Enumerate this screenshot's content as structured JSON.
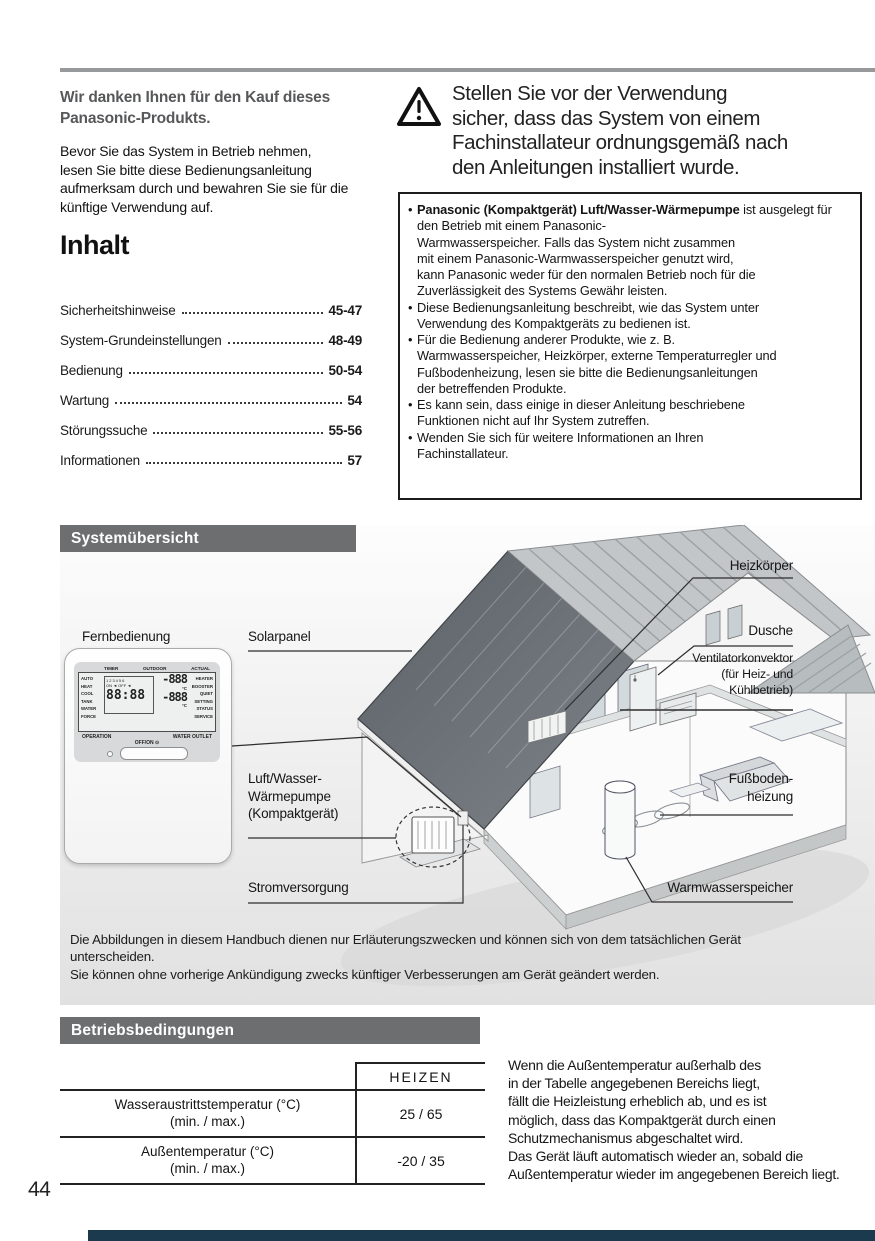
{
  "colors": {
    "section_bar": "#6d6e70",
    "footer_bar": "#1c3a4e",
    "rule": "#97999b"
  },
  "page": {
    "number": "44"
  },
  "intro": {
    "heading": "Wir danken Ihnen für den Kauf dieses Panasonic-Produkts.",
    "body": "Bevor Sie das System in Betrieb nehmen,\nlesen Sie bitte diese Bedienungsanleitung\naufmerksam durch und bewahren Sie sie für die\nkünftige Verwendung auf."
  },
  "toc": {
    "title": "Inhalt",
    "items": [
      {
        "label": "Sicherheitshinweise",
        "pages": "45-47"
      },
      {
        "label": "System-Grundeinstellungen",
        "pages": "48-49"
      },
      {
        "label": "Bedienung",
        "pages": "50-54"
      },
      {
        "label": "Wartung",
        "pages": "54"
      },
      {
        "label": "Störungssuche",
        "pages": "55-56"
      },
      {
        "label": "Informationen",
        "pages": "57"
      }
    ]
  },
  "warning": {
    "text": "Stellen Sie vor der Verwendung\nsicher, dass das System von einem\nFachinstallateur ordnungsgemäß nach\nden Anleitungen installiert wurde."
  },
  "notes_box": {
    "items": [
      {
        "bold": "Panasonic (Kompaktgerät) Luft/Wasser-Wärmepumpe",
        "text": " ist ausgelegt für den Betrieb mit einem Panasonic-\nWarmwasserspeicher. Falls das System nicht zusammen\nmit einem Panasonic-Warmwasserspeicher genutzt wird,\nkann Panasonic weder für den normalen Betrieb noch für die\nZuverlässigkeit des Systems Gewähr leisten."
      },
      {
        "bold": "",
        "text": "Diese Bedienungsanleitung beschreibt, wie das System unter\nVerwendung des Kompaktgeräts zu bedienen ist."
      },
      {
        "bold": "",
        "text": "Für die Bedienung anderer Produkte, wie z. B.\nWarmwasserspeicher, Heizkörper, externe Temperaturregler und\nFußbodenheizung, lesen sie bitte die Bedienungsanleitungen\nder betreffenden Produkte."
      },
      {
        "bold": "",
        "text": "Es kann sein, dass einige in dieser Anleitung beschriebene\nFunktionen nicht auf Ihr System zutreffen."
      },
      {
        "bold": "",
        "text": "Wenden Sie sich für weitere Informationen an Ihren\nFachinstallateur."
      }
    ]
  },
  "system_overview": {
    "title": "Systemübersicht",
    "labels": {
      "fernbedienung": "Fernbedienung",
      "solarpanel": "Solarpanel",
      "heizkoerper": "Heizkörper",
      "dusche": "Dusche",
      "ventilatorkonvektor": "Ventilatorkonvektor\n(für Heiz- und\nKühlbetrieb)",
      "fussbodenheizung": "Fußboden-\nheizung",
      "warmwasserspeicher": "Warmwasserspeicher",
      "luftwasser": "Luft/Wasser-\nWärmepumpe\n(Kompaktgerät)",
      "stromversorgung": "Stromversorgung"
    },
    "remote": {
      "lcd_top": {
        "timer": "TIMER",
        "outdoor": "OUTDOOR",
        "actual": "ACTUAL"
      },
      "lcd_left": "AUTO\nHEAT\nCOOL\nTANK\nWATER\nFORCE",
      "lcd_right": "HEATER\nBOOSTER\nQUIET\nSETTING\nSTATUS\nSERVICE",
      "days": "123456",
      "on_off": "ON ◄  OFF ◄",
      "clock": "88:88",
      "temp_outdoor": "-888",
      "temp_actual": "-888",
      "temp_unit": "°C",
      "operation": "OPERATION",
      "water_outlet": "WATER OUTLET",
      "power": "OFF/ON ⊙"
    },
    "note": "Die Abbildungen in diesem Handbuch dienen nur Erläuterungszwecken und können sich von dem tatsächlichen Gerät\nunterscheiden.\nSie können ohne vorherige Ankündigung zwecks künftiger Verbesserungen am Gerät geändert werden."
  },
  "operating_conditions": {
    "title": "Betriebsbedingungen",
    "table": {
      "column_header": "HEIZEN",
      "rows": [
        {
          "label": "Wasseraustrittstemperatur (°C)",
          "sub": "(min. / max.)",
          "value": "25 / 65"
        },
        {
          "label": "Außentemperatur (°C)",
          "sub": "(min. / max.)",
          "value": "-20 / 35"
        }
      ]
    },
    "text": "Wenn die Außentemperatur außerhalb des\nin der Tabelle angegebenen Bereichs liegt,\nfällt die Heizleistung erheblich ab, und es ist\nmöglich, dass das Kompaktgerät durch einen\nSchutzmechanismus abgeschaltet wird.\nDas Gerät läuft automatisch wieder an, sobald die\nAußentemperatur wieder im angegebenen Bereich liegt."
  }
}
